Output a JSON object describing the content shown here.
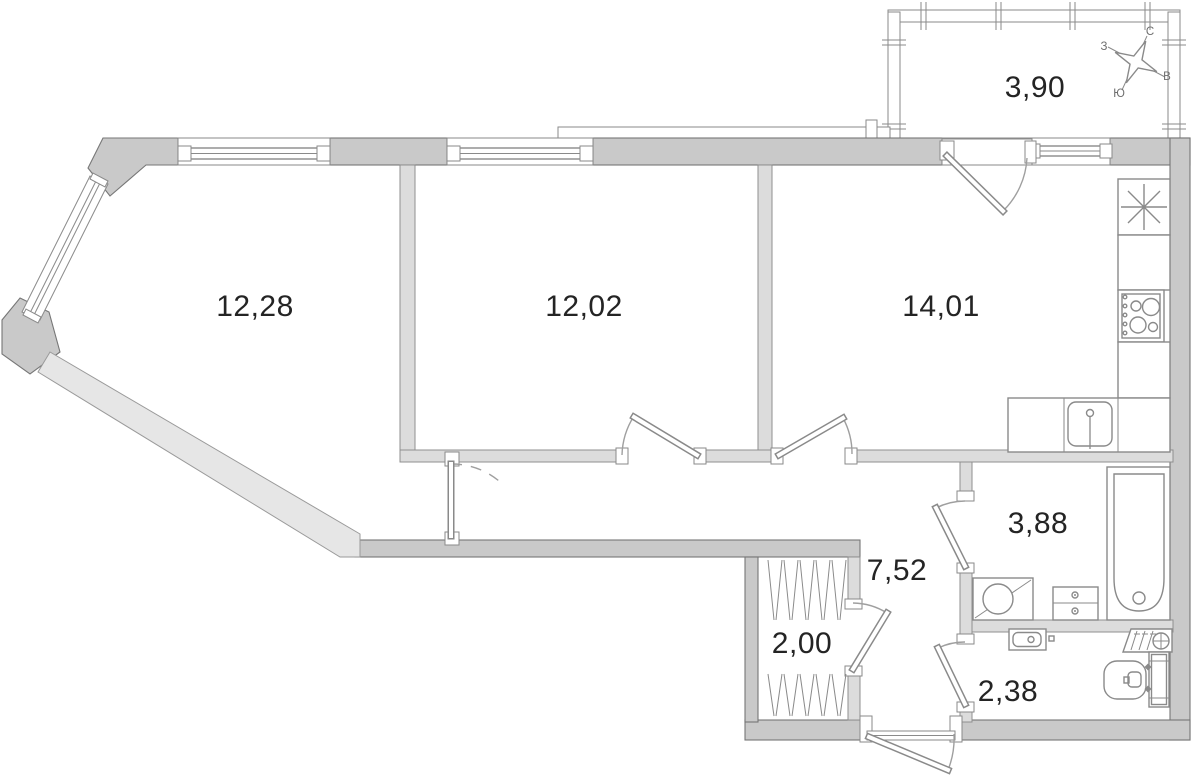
{
  "floorplan": {
    "rooms": [
      {
        "name": "living-room",
        "area": "12,28"
      },
      {
        "name": "bedroom",
        "area": "12,02"
      },
      {
        "name": "kitchen",
        "area": "14,01"
      },
      {
        "name": "balcony",
        "area": "3,90"
      },
      {
        "name": "hallway",
        "area": "7,52"
      },
      {
        "name": "wardrobe",
        "area": "2,00"
      },
      {
        "name": "bathroom",
        "area": "3,88"
      },
      {
        "name": "wc",
        "area": "2,38"
      }
    ],
    "compass": {
      "north": "С",
      "east": "В",
      "south": "Ю",
      "west": "З"
    },
    "icons": [
      "fridge-icon",
      "stove-icon",
      "kitchen-sink-icon",
      "bathtub-icon",
      "washing-machine-icon",
      "drawer-cabinet-icon",
      "wc-sink-icon",
      "radiator-icon",
      "toilet-icon",
      "wardrobe-rails-icon",
      "compass-rose-icon"
    ],
    "colors": {
      "wall_dark": "#c9c9c9",
      "wall_light": "#dcdcdc",
      "wall_diagonal": "#e6e6e6",
      "outline": "#8a8a8a",
      "label": "#242424"
    }
  }
}
